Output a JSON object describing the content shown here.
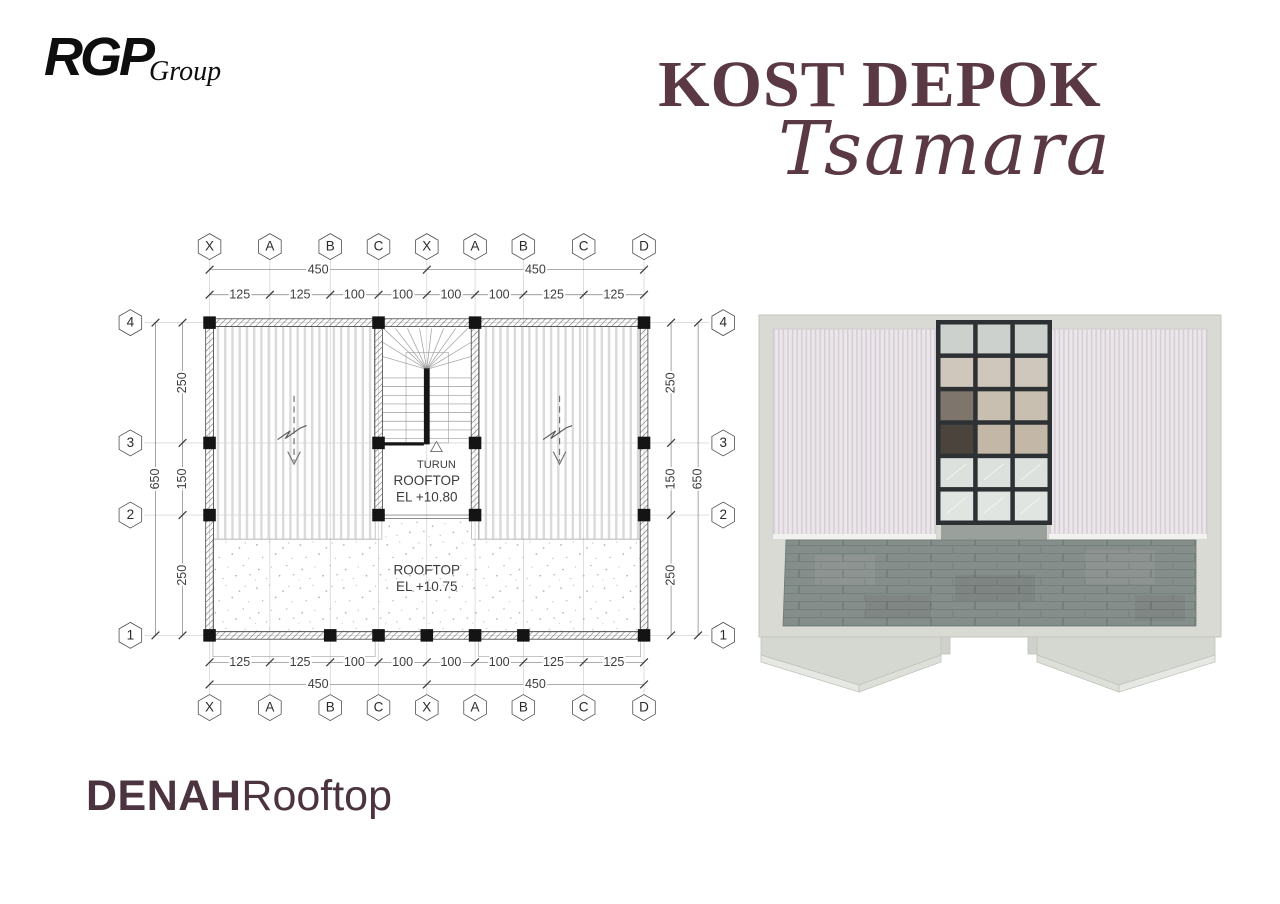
{
  "header": {
    "logo": {
      "primary": "RGP",
      "secondary": "Group"
    },
    "title": {
      "line1": "KOST DEPOK",
      "script": "Tsamara",
      "color": "#5b3944"
    }
  },
  "caption": {
    "bold": "DENAH",
    "regular": "Rooftop",
    "color": "#4b333f"
  },
  "plan": {
    "columns": {
      "labels": [
        "X",
        "A",
        "B",
        "C",
        "X",
        "A",
        "B",
        "C",
        "D"
      ],
      "positions": [
        0,
        125,
        250,
        350,
        450,
        550,
        650,
        775,
        900
      ]
    },
    "rows": {
      "labels": [
        "4",
        "3",
        "2",
        "1"
      ],
      "positions": [
        0,
        250,
        400,
        650
      ]
    },
    "dims": {
      "top_segments": [
        "125",
        "125",
        "100",
        "100",
        "100",
        "100",
        "125",
        "125"
      ],
      "top_totals": [
        "450",
        "450"
      ],
      "bottom_segments": [
        "125",
        "125",
        "100",
        "100",
        "100",
        "100",
        "125",
        "125"
      ],
      "bottom_totals": [
        "450",
        "450"
      ],
      "left_segments": [
        "250",
        "150",
        "250"
      ],
      "left_total": "650",
      "right_segments": [
        "250",
        "150",
        "250"
      ],
      "right_total": "650"
    },
    "labels": {
      "turun": "TURUN",
      "rooftop_upper_line1": "ROOFTOP",
      "rooftop_upper_line2": "EL +10.80",
      "rooftop_lower_line1": "ROOFTOP",
      "rooftop_lower_line2": "EL +10.75"
    },
    "ink_color": "#3d3d3d"
  },
  "render": {
    "wall_color": "#d8dad3",
    "roof_base_color": "#eae6e9",
    "roof_stripe_color": "#d5ced4",
    "skylight_frame_color": "#2e3134",
    "tile_color": "#868e8b",
    "tile_grout_color": "#74807c",
    "parapet_color": "#d5d8d1",
    "pane_row_colors": [
      "#ccd1cd",
      "#cfc7bb",
      "#c9bfb0",
      "#c3b8a8",
      "#dde1de",
      "#e1e5e2"
    ],
    "pane_dark_color": "#4a443d",
    "pane_stack_color": "#7e766c"
  }
}
